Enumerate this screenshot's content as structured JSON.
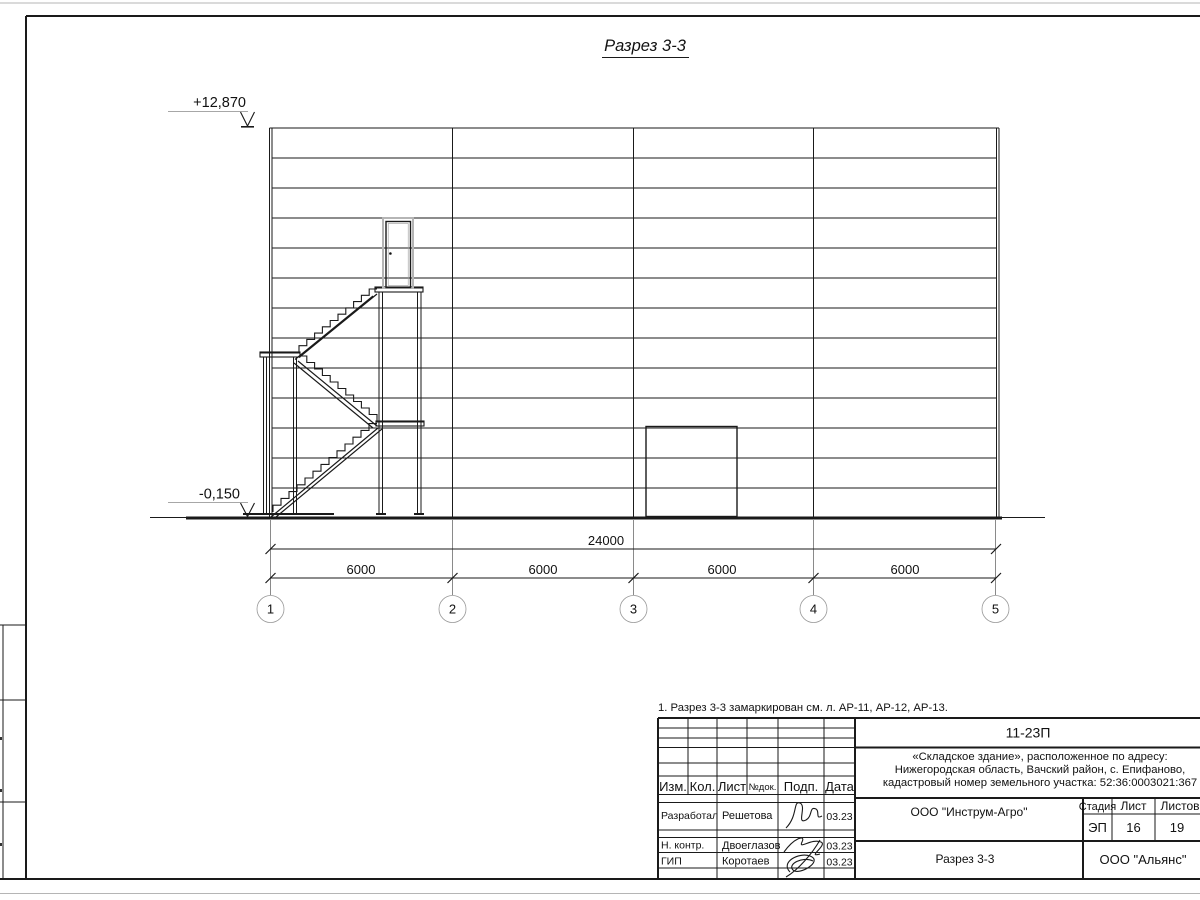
{
  "ink": "#1a1a1a",
  "paper": "#ffffff",
  "frame_gray": "#b5b5b5",
  "sheet": {
    "title": "Разрез 3-3",
    "note": "1. Разрез 3-3 замаркирован см. л. АР-11, АР-12, АР-13.",
    "elevations": {
      "top": "+12,870",
      "bottom": "-0,150"
    },
    "dimensions": {
      "total": "24000",
      "spans": [
        "6000",
        "6000",
        "6000",
        "6000"
      ]
    },
    "axes": [
      "1",
      "2",
      "3",
      "4",
      "5"
    ]
  },
  "title_block": {
    "doc_number": "11-23П",
    "object_address_lines": [
      "«Складское здание», расположенное по адресу:",
      "Нижегородская область, Вачский район, с. Епифаново,",
      "кадастровый номер земельного участка: 52:36:0003021:367"
    ],
    "header_cols": [
      "Изм.",
      "Кол.",
      "Лист",
      "№док.",
      "Подп.",
      "Дата"
    ],
    "rows": [
      {
        "role": "Разработал",
        "name": "Решетова",
        "date": "03.23"
      },
      {
        "role": "Н. контр.",
        "name": "Двоеглазов",
        "date": "03.23"
      },
      {
        "role": "ГИП",
        "name": "Коротаев",
        "date": "03.23"
      }
    ],
    "org": "ООО \"Инструм-Агро\"",
    "sheet_title": "Разрез 3-3",
    "company": "ООО \"Альянс\"",
    "stage_label": "Стадия",
    "sheet_label": "Лист",
    "sheets_label": "Листов",
    "stage": "ЭП",
    "sheet": "16",
    "sheets": "19"
  }
}
